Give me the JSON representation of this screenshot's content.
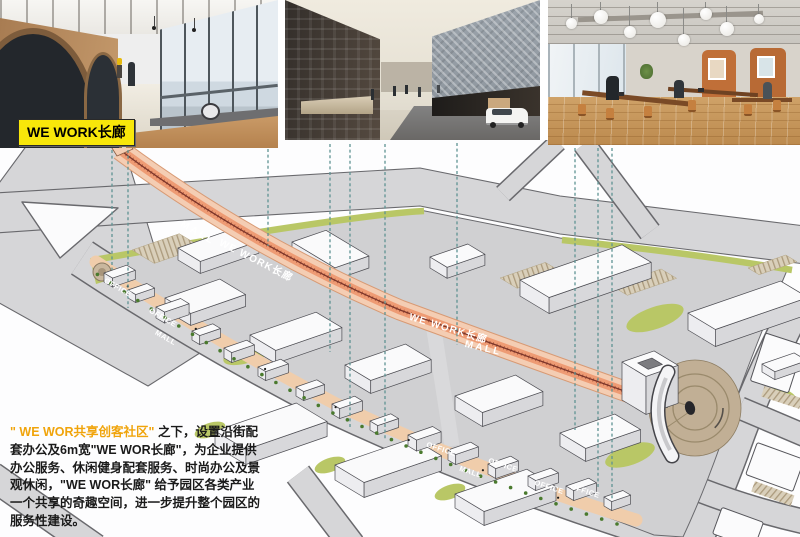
{
  "tag": {
    "label": "WE WORK长廊"
  },
  "photos": [
    {
      "name": "wework-corridor-interior-photo"
    },
    {
      "name": "street-view-render-photo"
    },
    {
      "name": "coworking-space-photo"
    }
  ],
  "plan": {
    "corridor_labels": [
      {
        "text": "MALL"
      },
      {
        "text": "WE WORK长廊"
      },
      {
        "text": "WE WORK长廊"
      },
      {
        "text": "MALL"
      }
    ],
    "street_labels": [
      {
        "text": "OFFICE"
      },
      {
        "text": "OFFICE"
      },
      {
        "text": "MALL"
      },
      {
        "text": "OFFICE"
      },
      {
        "text": "MALL"
      },
      {
        "text": "OFFICE"
      },
      {
        "text": "OFFICE"
      },
      {
        "text": "OFFICE"
      }
    ]
  },
  "paragraph": {
    "seg0": "\" WE WOR共享创客社区\"",
    "seg1": " 之下，设置沿街配套办公及6m宽",
    "seg2": "\"WE WOR长廊\"",
    "seg3": "，为企业提供办公服务、休闲健身配套服务、时尚办公及景观休闲，",
    "seg4": "\"WE WOR长廊\"",
    "seg5": " 给予园区各类产业一个共享的奇趣空间，进一步提升整个园区的服务性建设。"
  },
  "colors": {
    "tag_yellow": "#f8e70a",
    "highlight_orange": "#f0a40b",
    "corridor_salmon": "#ee9b74",
    "leader_teal": "#5f9393",
    "landscape_green": "#b9c766"
  }
}
